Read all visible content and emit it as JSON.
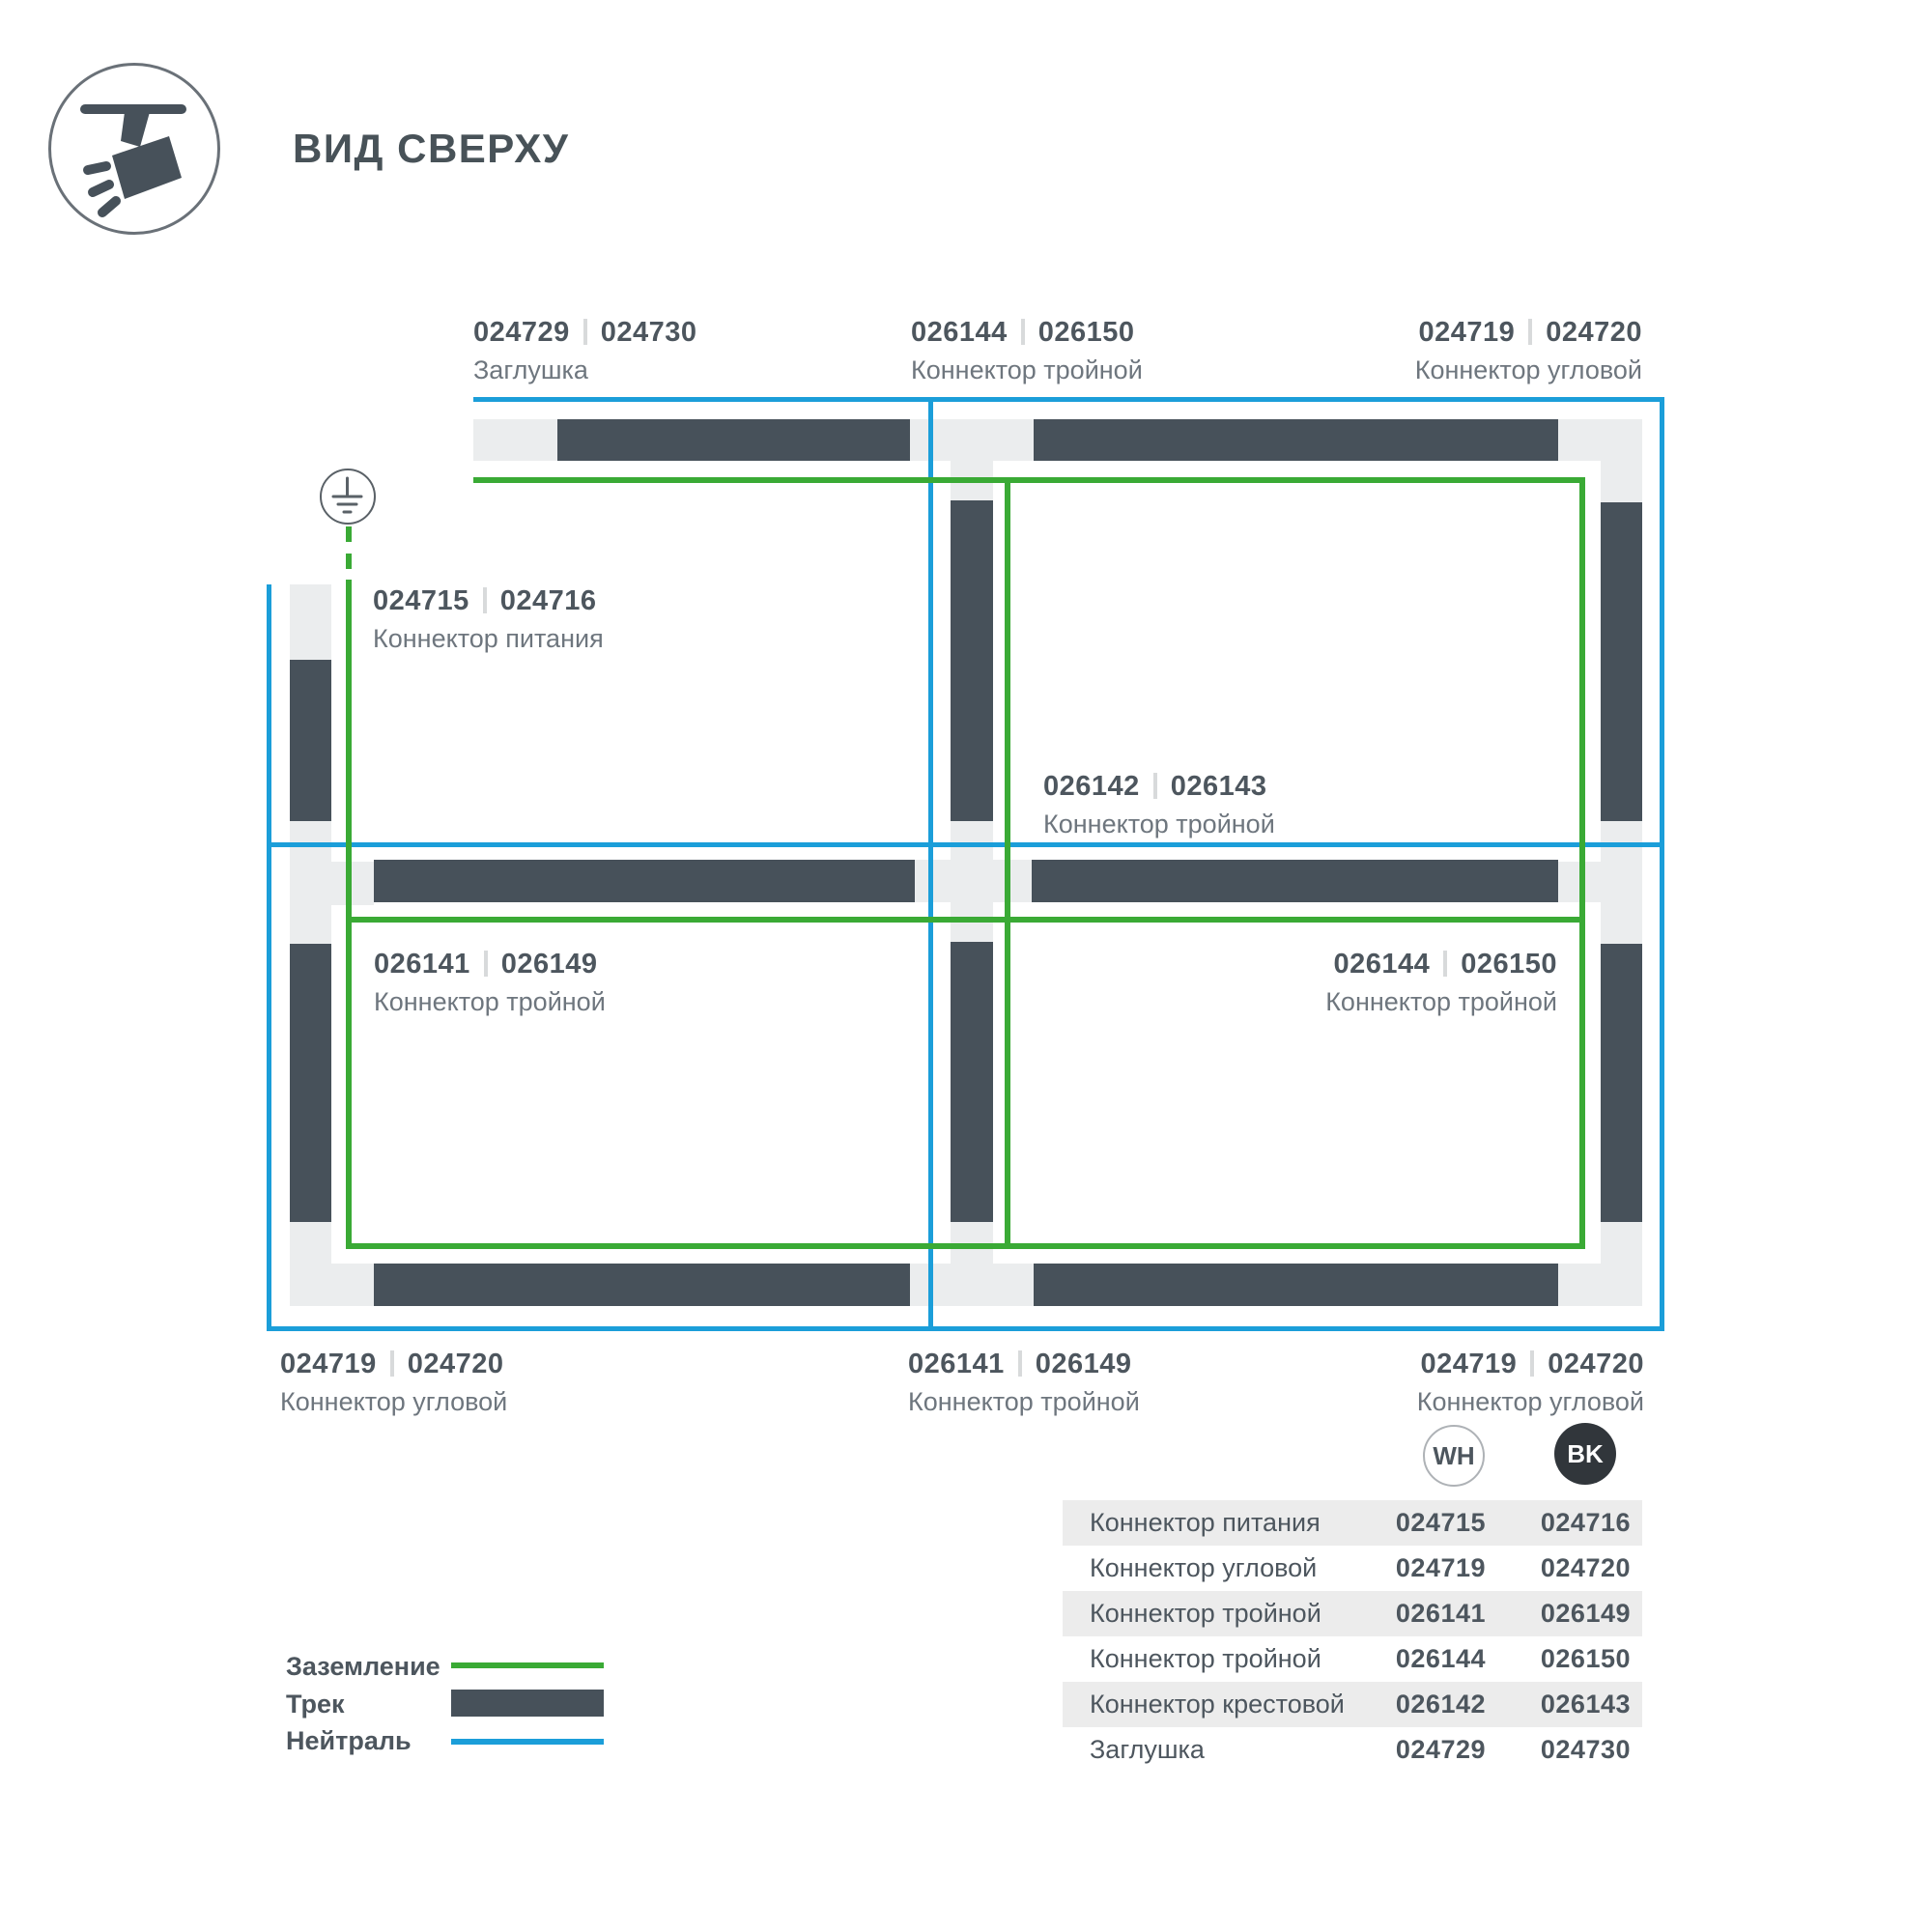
{
  "header": {
    "title": "ВИД СВЕРХУ"
  },
  "diagram": {
    "labels": {
      "top_left": {
        "wh": "024729",
        "bk": "024730",
        "name": "Заглушка"
      },
      "top_mid": {
        "wh": "026144",
        "bk": "026150",
        "name": "Коннектор тройной"
      },
      "top_right": {
        "wh": "024719",
        "bk": "024720",
        "name": "Коннектор угловой"
      },
      "power": {
        "wh": "024715",
        "bk": "024716",
        "name": "Коннектор питания"
      },
      "cross": {
        "wh": "026142",
        "bk": "026143",
        "name": "Коннектор тройной"
      },
      "mid_left": {
        "wh": "026141",
        "bk": "026149",
        "name": "Коннектор тройной"
      },
      "mid_right": {
        "wh": "026144",
        "bk": "026150",
        "name": "Коннектор тройной"
      },
      "bottom_left": {
        "wh": "024719",
        "bk": "024720",
        "name": "Коннектор угловой"
      },
      "bottom_mid": {
        "wh": "026141",
        "bk": "026149",
        "name": "Коннектор тройной"
      },
      "bottom_right": {
        "wh": "024719",
        "bk": "024720",
        "name": "Коннектор угловой"
      }
    }
  },
  "badges": {
    "white": "WH",
    "black": "BK"
  },
  "legend": {
    "ground": {
      "label": "Заземление",
      "color": "#3aaa35"
    },
    "track": {
      "label": "Трек",
      "color": "#47515a"
    },
    "neutral": {
      "label": "Нейтраль",
      "color": "#1b9ed9"
    }
  },
  "table": {
    "rows": [
      {
        "name": "Коннектор питания",
        "wh": "024715",
        "bk": "024716"
      },
      {
        "name": "Коннектор угловой",
        "wh": "024719",
        "bk": "024720"
      },
      {
        "name": "Коннектор тройной",
        "wh": "026141",
        "bk": "026149"
      },
      {
        "name": "Коннектор тройной",
        "wh": "026144",
        "bk": "026150"
      },
      {
        "name": "Коннектор крестовой",
        "wh": "026142",
        "bk": "026143"
      },
      {
        "name": "Заглушка",
        "wh": "024729",
        "bk": "024730"
      }
    ]
  },
  "colors": {
    "ground": "#3aaa35",
    "neutral": "#1b9ed9",
    "track": "#47515a",
    "connector": "#ebedee"
  }
}
